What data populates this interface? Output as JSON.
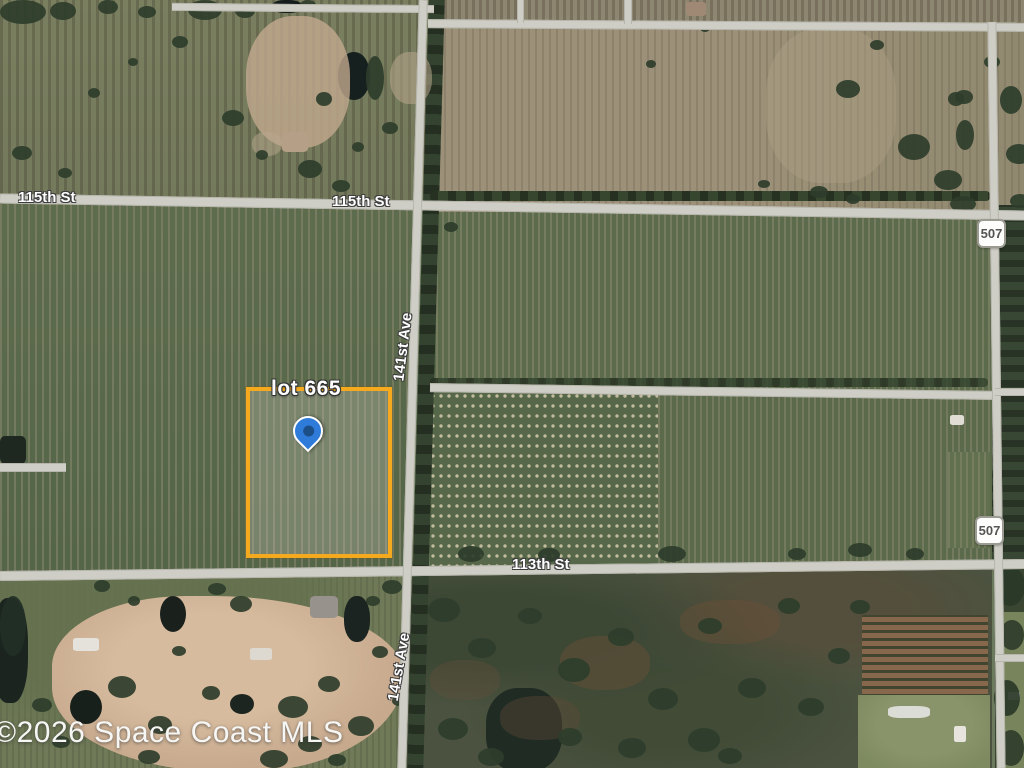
{
  "map": {
    "watermark": "©2026 Space Coast MLS",
    "parcel_label": "lot 665",
    "street_labels": {
      "st115_left": "115th St",
      "st115_right": "115th St",
      "st113": "113th St",
      "ave141_upper": "141st Ave",
      "ave141_lower": "141st Ave"
    },
    "route_shields": {
      "upper": "507",
      "lower": "507"
    },
    "colors": {
      "parcel_border": "#F5A91F",
      "pin_fill": "#2F7BD9",
      "pin_dot": "#1C4E87",
      "road": "#CFCEC6",
      "tree": "#2E3D2B"
    }
  }
}
